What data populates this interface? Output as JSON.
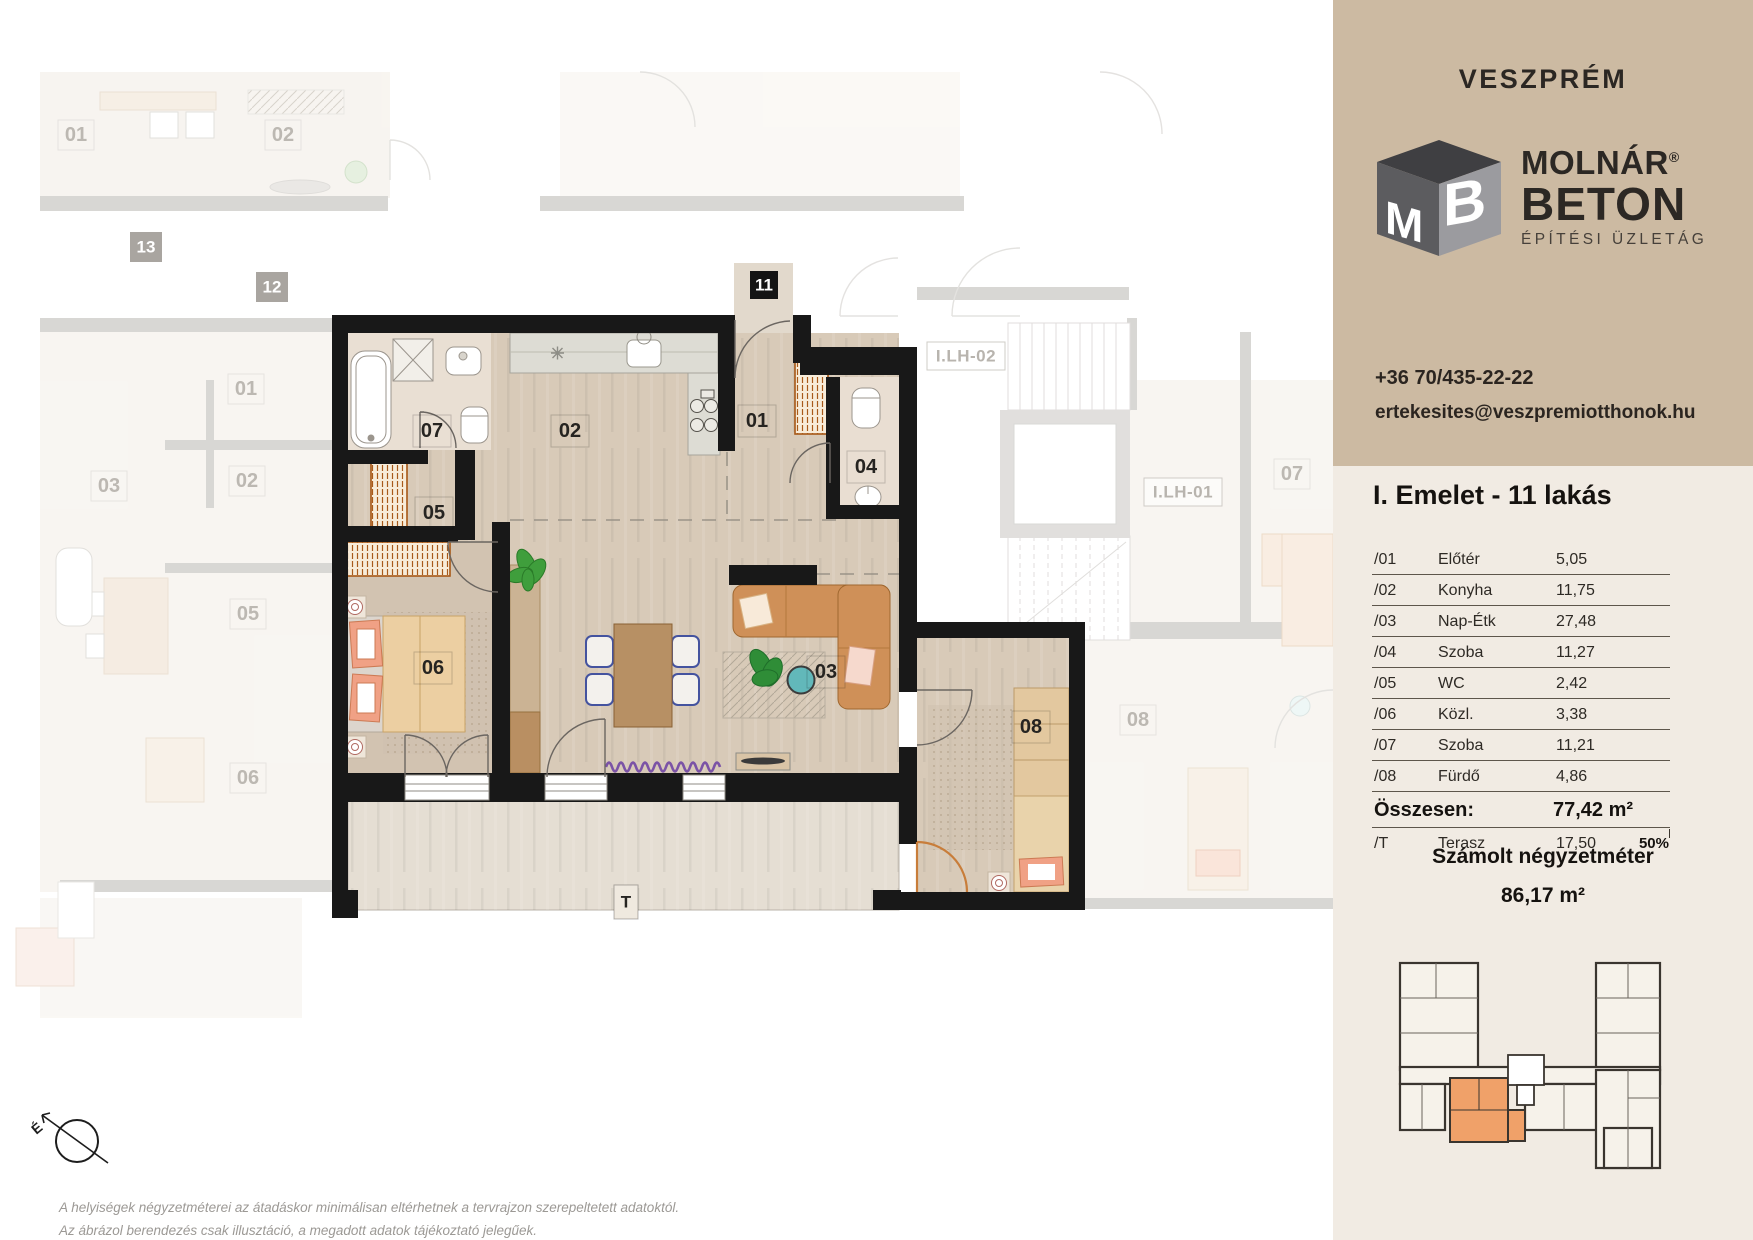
{
  "sidebar": {
    "city": "VESZPRÉM",
    "logo": {
      "letter_m": "M",
      "letter_b": "B",
      "name_line1": "MOLNÁR",
      "registered": "®",
      "name_line2": "BETON",
      "tagline": "ÉPÍTÉSI ÜZLETÁG"
    },
    "contact": {
      "phone": "+36 70/435-22-22",
      "email": "ertekesites@veszpremiotthonok.hu"
    },
    "floor_title": "I. Emelet - 11 lakás",
    "table": {
      "rows": [
        {
          "num": "/01",
          "name": "Előtér",
          "value": "5,05"
        },
        {
          "num": "/02",
          "name": "Konyha",
          "value": "11,75"
        },
        {
          "num": "/03",
          "name": "Nap-Étk",
          "value": "27,48"
        },
        {
          "num": "/04",
          "name": "Szoba",
          "value": "11,27"
        },
        {
          "num": "/05",
          "name": "WC",
          "value": "2,42"
        },
        {
          "num": "/06",
          "name": "Közl.",
          "value": "3,38"
        },
        {
          "num": "/07",
          "name": "Szoba",
          "value": "11,21"
        },
        {
          "num": "/08",
          "name": "Fürdő",
          "value": "4,86"
        }
      ],
      "total_label": "Összesen:",
      "total_value": "77,42 m²",
      "terrace_row": {
        "num": "/T",
        "name": "Terasz",
        "value": "17,50",
        "percent": "50%"
      }
    },
    "calculated": {
      "heading": "Számolt négyzetméter",
      "value": "86,17 m²"
    },
    "colors": {
      "header_bg": "#ccbaa2",
      "body_bg": "#f1ebe3",
      "highlight_unit": "#f0a169",
      "logo_dark": "#4a4a4d",
      "wall_black": "#181818"
    }
  },
  "plan": {
    "labels": [
      {
        "text": "11",
        "x": 764,
        "y": 285,
        "kind": "badge-dark"
      },
      {
        "text": "07",
        "x": 432,
        "y": 431,
        "kind": "room"
      },
      {
        "text": "05",
        "x": 434,
        "y": 513,
        "kind": "room"
      },
      {
        "text": "02",
        "x": 570,
        "y": 431,
        "kind": "room"
      },
      {
        "text": "01",
        "x": 757,
        "y": 421,
        "kind": "room"
      },
      {
        "text": "04",
        "x": 866,
        "y": 467,
        "kind": "room"
      },
      {
        "text": "06",
        "x": 433,
        "y": 668,
        "kind": "room"
      },
      {
        "text": "03",
        "x": 826,
        "y": 672,
        "kind": "room"
      },
      {
        "text": "08",
        "x": 1031,
        "y": 727,
        "kind": "room"
      },
      {
        "text": "T",
        "x": 626,
        "y": 902,
        "kind": "terrace"
      },
      {
        "text": "13",
        "x": 146,
        "y": 247,
        "kind": "badge-gray"
      },
      {
        "text": "12",
        "x": 272,
        "y": 287,
        "kind": "badge-gray"
      },
      {
        "text": "01",
        "x": 76,
        "y": 135,
        "kind": "faded"
      },
      {
        "text": "02",
        "x": 283,
        "y": 135,
        "kind": "faded"
      },
      {
        "text": "01",
        "x": 246,
        "y": 389,
        "kind": "faded"
      },
      {
        "text": "02",
        "x": 247,
        "y": 481,
        "kind": "faded"
      },
      {
        "text": "03",
        "x": 109,
        "y": 486,
        "kind": "faded"
      },
      {
        "text": "05",
        "x": 248,
        "y": 614,
        "kind": "faded"
      },
      {
        "text": "06",
        "x": 248,
        "y": 778,
        "kind": "faded"
      },
      {
        "text": "07",
        "x": 1292,
        "y": 474,
        "kind": "faded"
      },
      {
        "text": "08",
        "x": 1138,
        "y": 720,
        "kind": "faded"
      },
      {
        "text": "I.LH-02",
        "x": 966,
        "y": 356,
        "kind": "stair"
      },
      {
        "text": "I.LH-01",
        "x": 1183,
        "y": 492,
        "kind": "stair"
      }
    ]
  },
  "footer": {
    "compass_letter": "É",
    "disclaimer_line1": "A helyiségek négyzetméterei az átadáskor minimálisan eltérhetnek a tervrajzon szerepeltetett adatoktól.",
    "disclaimer_line2": "Az ábrázol berendezés csak illusztáció, a megadott adatok tájékoztató jelegűek."
  }
}
